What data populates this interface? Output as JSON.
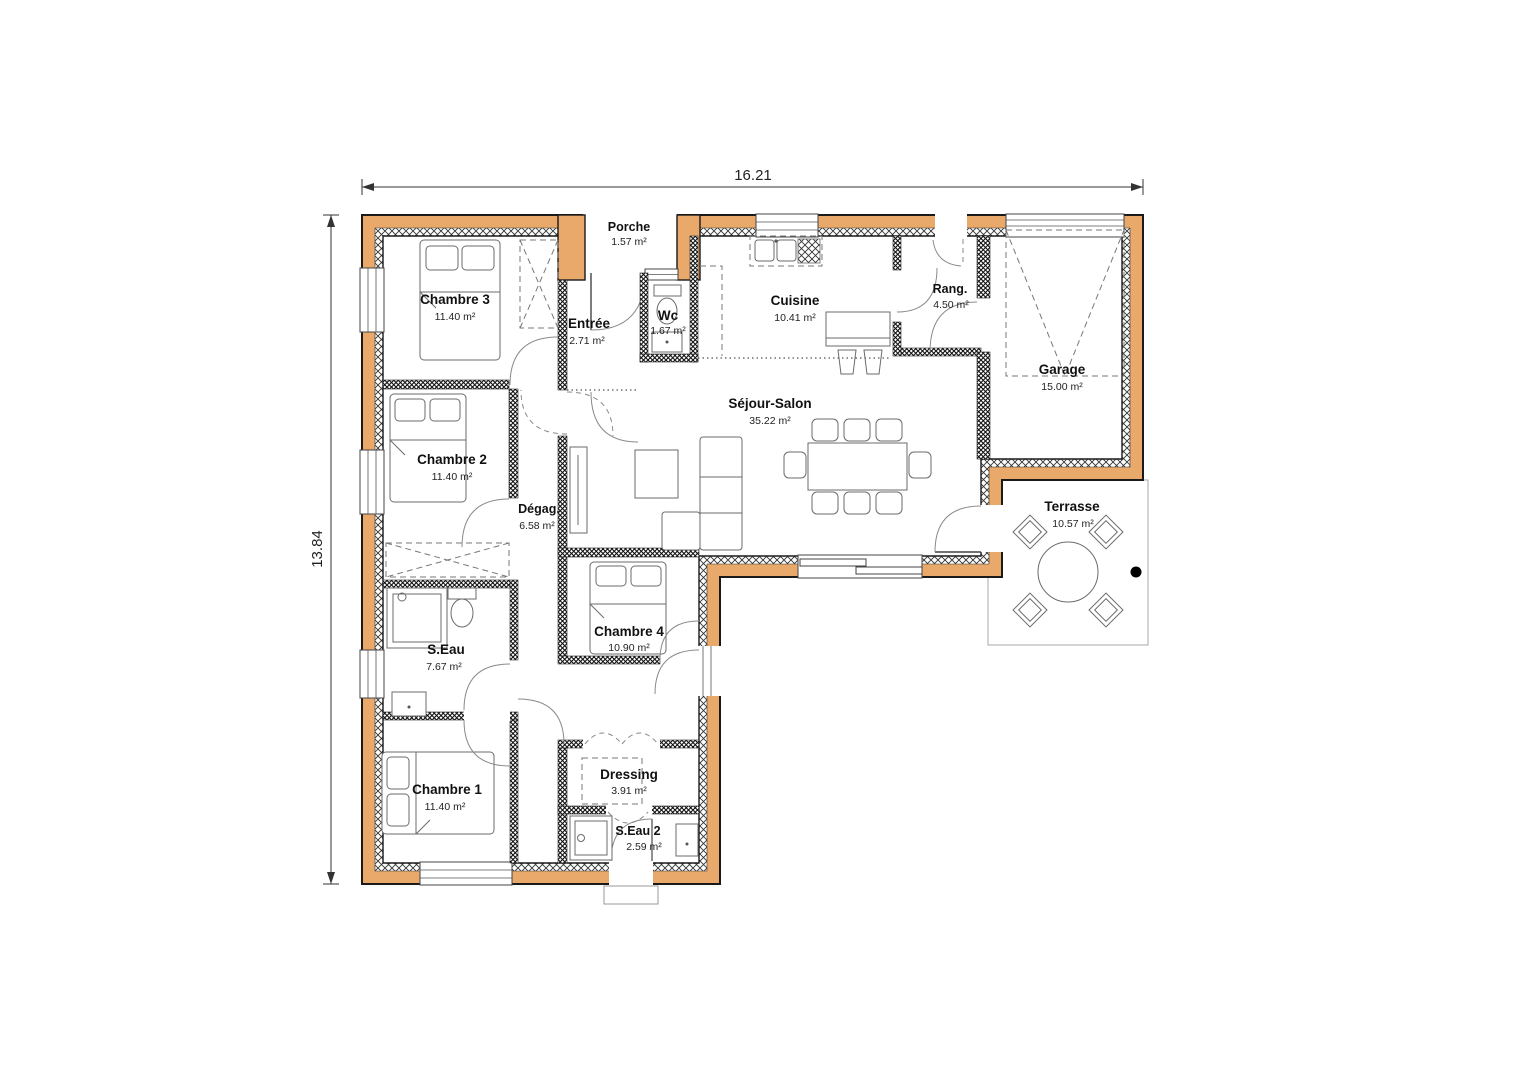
{
  "plan": {
    "dimensions": {
      "width": "16.21",
      "height": "13.84"
    },
    "rooms": [
      {
        "name": "Porche",
        "area": "1.57 m²"
      },
      {
        "name": "Chambre 3",
        "area": "11.40 m²"
      },
      {
        "name": "Entrée",
        "area": "2.71 m²"
      },
      {
        "name": "Wc",
        "area": "1.67 m²"
      },
      {
        "name": "Cuisine",
        "area": "10.41 m²"
      },
      {
        "name": "Rang.",
        "area": "4.50 m²"
      },
      {
        "name": "Garage",
        "area": "15.00 m²"
      },
      {
        "name": "Chambre 2",
        "area": "11.40 m²"
      },
      {
        "name": "Dégag.",
        "area": "6.58 m²"
      },
      {
        "name": "Séjour-Salon",
        "area": "35.22 m²"
      },
      {
        "name": "Terrasse",
        "area": "10.57 m²"
      },
      {
        "name": "S.Eau",
        "area": "7.67 m²"
      },
      {
        "name": "Chambre 4",
        "area": "10.90 m²"
      },
      {
        "name": "Chambre 1",
        "area": "11.40 m²"
      },
      {
        "name": "Dressing",
        "area": "3.91 m²"
      },
      {
        "name": "S.Eau 2",
        "area": "2.59 m²"
      }
    ],
    "colors": {
      "wall": "#E8A96B",
      "outline": "#1a1a1a"
    }
  }
}
